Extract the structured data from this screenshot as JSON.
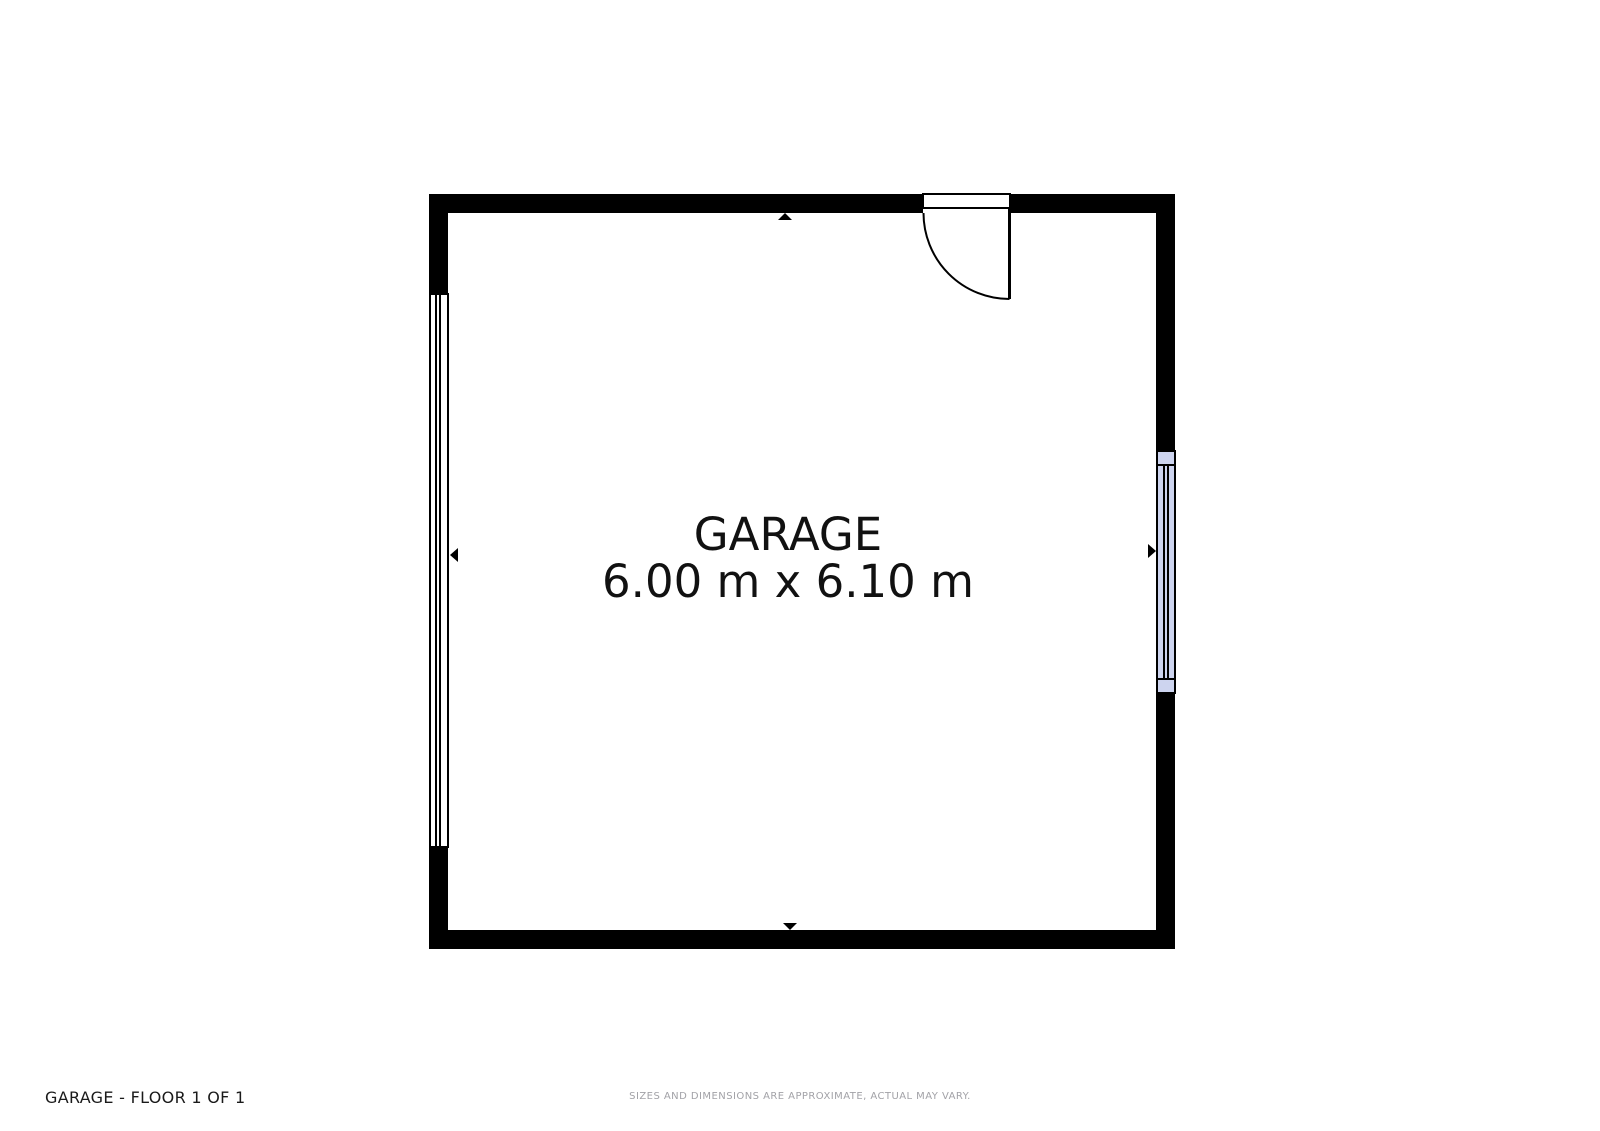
{
  "floorplan": {
    "room": {
      "name": "GARAGE",
      "dimensions": "6.00 m x 6.10 m"
    },
    "footer": {
      "title": "GARAGE - FLOOR 1 OF 1",
      "disclaimer": "SIZES AND DIMENSIONS ARE APPROXIMATE, ACTUAL MAY VARY."
    },
    "colors": {
      "wall": "#000000",
      "floor": "#ffffff",
      "window_glass_right": "#cdd4ef",
      "window_glass_left": "#ffffff",
      "room_label_text": "#111111",
      "footer_title_text": "#1a1a1a",
      "disclaimer_text": "#a2a2a7"
    },
    "icons": {
      "north_arrow": "▲",
      "south_arrow": "▼",
      "west_arrow": "◀",
      "east_arrow": "▶",
      "door_swing": "quarter-circle-arc"
    }
  }
}
